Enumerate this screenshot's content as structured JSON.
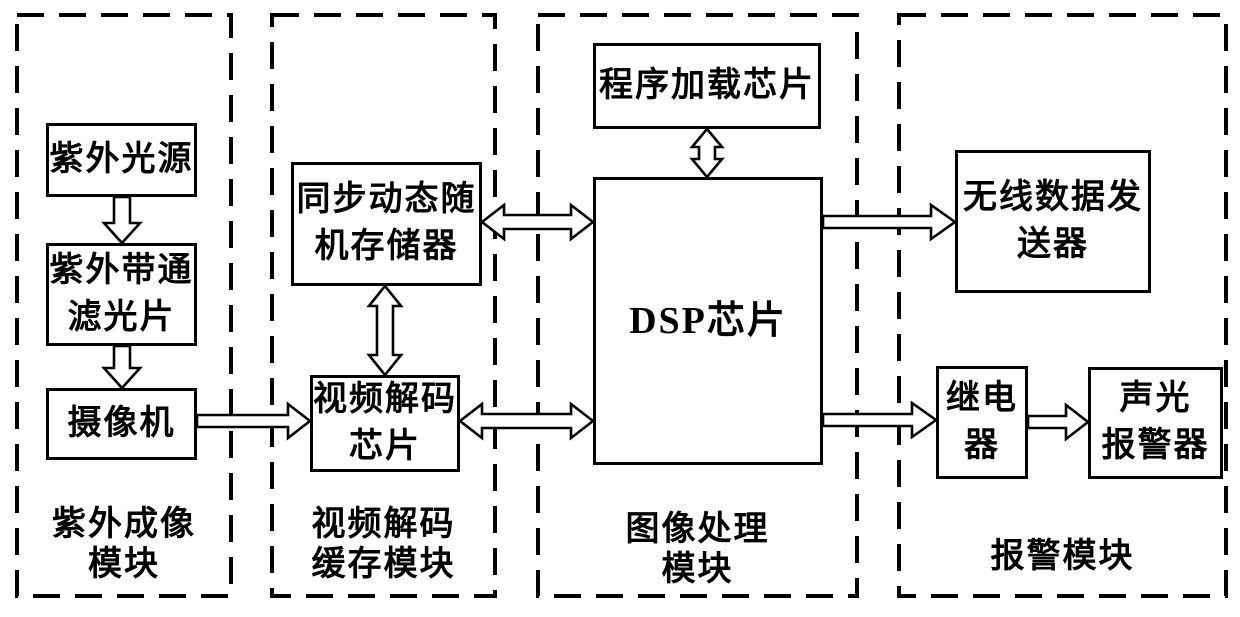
{
  "modules": {
    "uv_imaging": {
      "label": "紫外成像模块",
      "lines": [
        "紫外成像",
        "模块"
      ]
    },
    "video_decode_buffer": {
      "label": "视频解码缓存模块",
      "lines": [
        "视频解码",
        "缓存模块"
      ]
    },
    "image_processing": {
      "label": "图像处理模块",
      "lines": [
        "图像处理",
        "模块"
      ]
    },
    "alarm": {
      "label": "报警模块",
      "lines": [
        "报警模块"
      ]
    }
  },
  "nodes": {
    "uv_source": {
      "label": "紫外光源",
      "lines": [
        "紫外光源"
      ]
    },
    "uv_filter": {
      "label": "紫外带通滤光片",
      "lines": [
        "紫外带通",
        "滤光片"
      ]
    },
    "camera": {
      "label": "摄像机",
      "lines": [
        "摄像机"
      ]
    },
    "sdram": {
      "label": "同步动态随机存储器",
      "lines": [
        "同步动态随",
        "机存储器"
      ]
    },
    "video_decoder": {
      "label": "视频解码芯片",
      "lines": [
        "视频解码",
        "芯片"
      ]
    },
    "program_loader": {
      "label": "程序加载芯片",
      "lines": [
        "程序加载芯片"
      ]
    },
    "dsp": {
      "label": "DSP芯片",
      "lines": [
        "DSP芯片"
      ]
    },
    "wireless_tx": {
      "label": "无线数据发送器",
      "lines": [
        "无线数据发",
        "送器"
      ]
    },
    "relay": {
      "label": "继电器",
      "lines": [
        "继电",
        "器"
      ]
    },
    "sound_light_alarm": {
      "label": "声光报警器",
      "lines": [
        "声光",
        "报警器"
      ]
    }
  },
  "connections": [
    {
      "from": "uv_source",
      "to": "uv_filter",
      "type": "single"
    },
    {
      "from": "uv_filter",
      "to": "camera",
      "type": "single"
    },
    {
      "from": "camera",
      "to": "video_decoder",
      "type": "single"
    },
    {
      "from": "sdram",
      "to": "video_decoder",
      "type": "double"
    },
    {
      "from": "sdram",
      "to": "dsp",
      "type": "double"
    },
    {
      "from": "video_decoder",
      "to": "dsp",
      "type": "double"
    },
    {
      "from": "program_loader",
      "to": "dsp",
      "type": "double"
    },
    {
      "from": "dsp",
      "to": "wireless_tx",
      "type": "single"
    },
    {
      "from": "dsp",
      "to": "relay",
      "type": "single"
    },
    {
      "from": "relay",
      "to": "sound_light_alarm",
      "type": "single"
    }
  ],
  "colors": {
    "line": "#000000",
    "background": "#ffffff"
  }
}
